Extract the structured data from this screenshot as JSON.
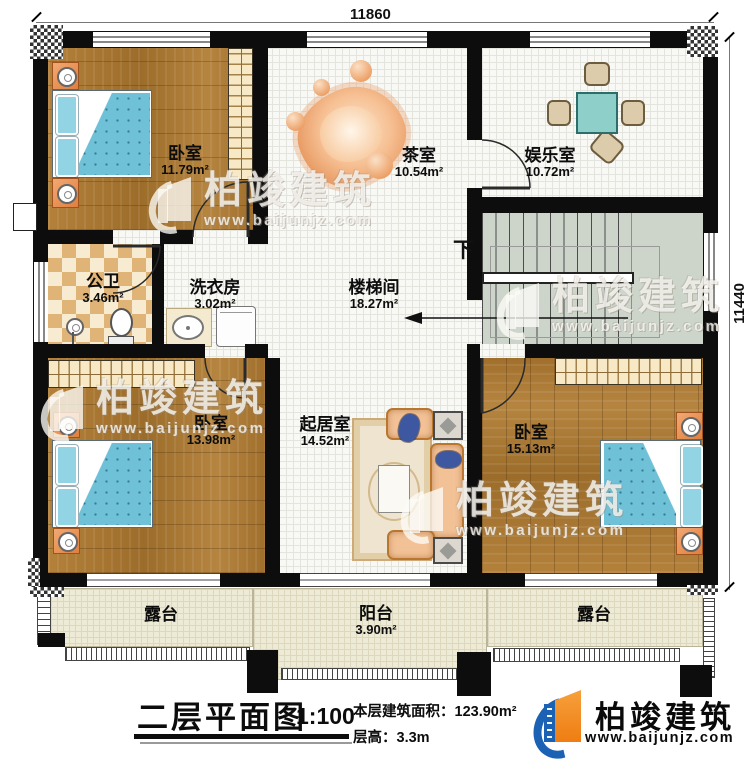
{
  "dims": {
    "top": "11860",
    "right": "11440"
  },
  "rooms": {
    "bedroom_tl": {
      "name": "卧室",
      "area": "11.79m²"
    },
    "tea": {
      "name": "茶室",
      "area": "10.54m²"
    },
    "entertainment": {
      "name": "娱乐室",
      "area": "10.72m²"
    },
    "bath": {
      "name": "公卫",
      "area": "3.46m²"
    },
    "laundry": {
      "name": "洗衣房",
      "area": "3.02m²"
    },
    "stairhall": {
      "name": "楼梯间",
      "area": "18.27m²"
    },
    "bedroom_bl": {
      "name": "卧室",
      "area": "13.98m²"
    },
    "living": {
      "name": "起居室",
      "area": "14.52m²"
    },
    "bedroom_br": {
      "name": "卧室",
      "area": "15.13m²"
    },
    "terrace_left": {
      "name": "露台"
    },
    "balcony": {
      "name": "阳台",
      "area": "3.90m²"
    },
    "terrace_right": {
      "name": "露台"
    }
  },
  "stairs": {
    "down": "下"
  },
  "footer": {
    "title": "二层平面图",
    "scale": "1:100",
    "area_line": "本层建筑面积：123.90m²",
    "height_line": "层高：3.3m"
  },
  "brand": {
    "name": "柏竣建筑",
    "url": "www.baijunjz.com"
  },
  "watermark": {
    "name": "柏竣建筑",
    "url": "www.baijunjz.com"
  },
  "colors": {
    "wall": "#0d0d0d",
    "wood": "#a97832",
    "bed_blue": "#6fc1d8",
    "stair_green": "#cdd5cb",
    "brand_blue": "#1b62b5",
    "brand_orange": "#ef7d12"
  }
}
